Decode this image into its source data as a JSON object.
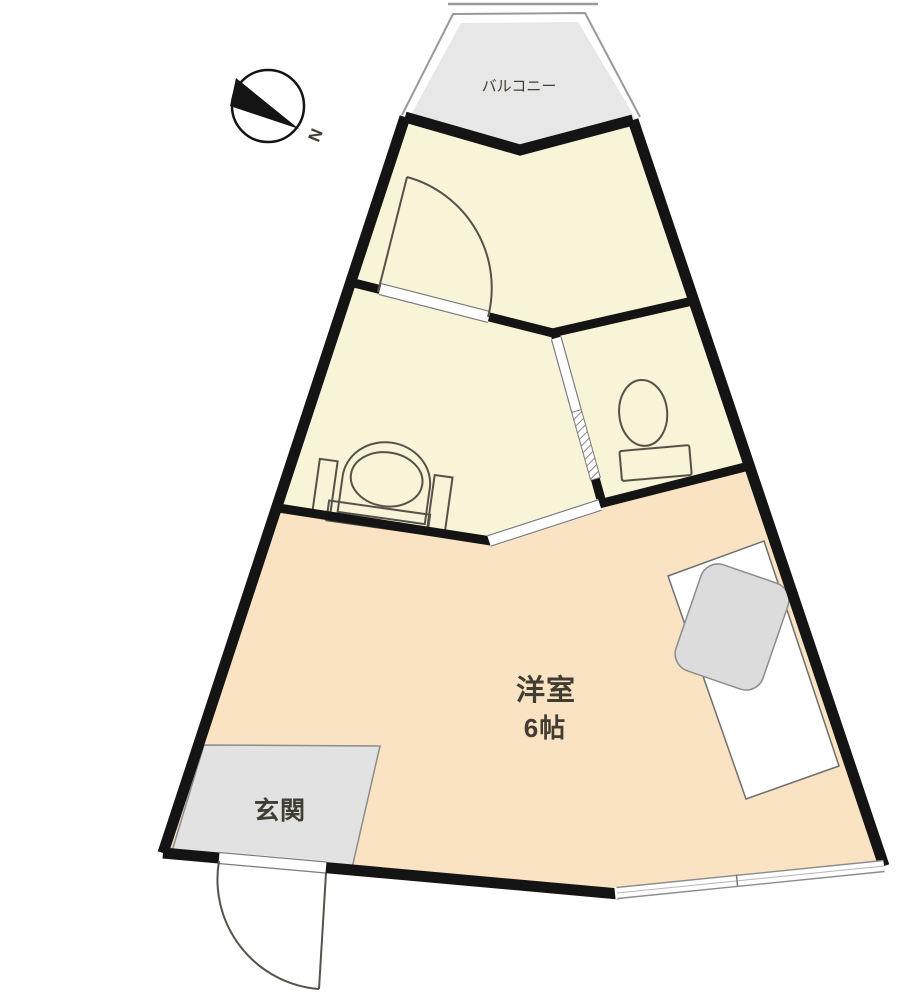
{
  "plan": {
    "type": "apartment-floor-plan",
    "labels": {
      "balcony": "バルコニー",
      "entrance": "玄関",
      "western_room": "洋室",
      "western_room_size": "6帖",
      "compass_north": "N"
    },
    "colors": {
      "room_cream": "#f8f4d8",
      "room_peach": "#fae3c3",
      "balcony_gray": "#e7e7e7",
      "entrance_gray": "#e2e2e2",
      "sink_gray": "#dcdcdc",
      "wall_black": "#141414",
      "fixture_line": "#56524a",
      "thin_line": "#8c8c8c",
      "label_text": "#42: use #423d33"
    }
  }
}
